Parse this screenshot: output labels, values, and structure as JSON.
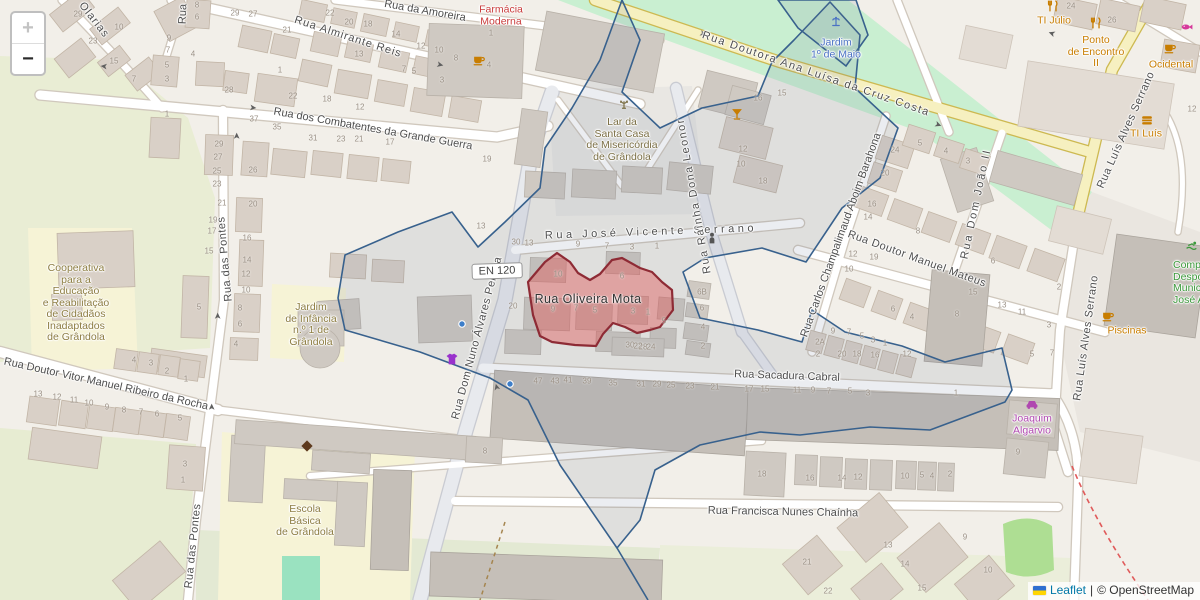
{
  "attribution": {
    "leaflet": "Leaflet",
    "separator": "|",
    "osm": "© OpenStreetMap"
  },
  "controls": {
    "zoom_in": "+",
    "zoom_out": "−"
  },
  "shield": {
    "label": "EN 120"
  },
  "highlight": {
    "label": "Rua Oliveira Mota"
  },
  "colors": {
    "highlight_fill": "#e05a5a",
    "highlight_stroke": "#8e2b35",
    "boundary": "#38618d",
    "park_green": "#c9efd1",
    "school_yellow": "#f6f3d6",
    "road_yellow": "#f6f0c0",
    "poi_orange": "#c87d00",
    "pharmacy_red": "#c93c3c",
    "garden_blue": "#4a71c4",
    "amenity_brown": "#8d7d42",
    "shop_purple": "#b048b0",
    "leisure_green": "#3c9a3c",
    "attribution_link": "#0078A8",
    "housenumber_gray": "#9b9186"
  },
  "street_labels": [
    {
      "t": "Rua da Amoreira",
      "x": 425,
      "y": 11,
      "r": 10,
      "ls": 0
    },
    {
      "t": "Rua Almirante Reis",
      "x": 348,
      "y": 37,
      "r": 18,
      "ls": 1
    },
    {
      "t": "Rua dos Combatentes da Grande Guerra",
      "x": 373,
      "y": 129,
      "r": 10,
      "ls": 0
    },
    {
      "t": "Olarias",
      "x": 94,
      "y": 20,
      "r": 52,
      "ls": 1
    },
    {
      "t": "Rua",
      "x": 183,
      "y": 14,
      "r": -88,
      "ls": 0
    },
    {
      "t": "Rua Doutora Ana Luísa da Cruz Costa",
      "x": 816,
      "y": 74,
      "r": 19,
      "ls": 1.5
    },
    {
      "t": "Rua Luís Alves Serrano",
      "x": 1126,
      "y": 130,
      "r": -66,
      "ls": 0.5
    },
    {
      "t": "Rua Luís Alves Serrano",
      "x": 1086,
      "y": 338,
      "r": -82,
      "ls": 0.5
    },
    {
      "t": "Rua das Pontes",
      "x": 225,
      "y": 259,
      "r": -95,
      "ls": 0.5
    },
    {
      "t": "Rua das Pontes",
      "x": 193,
      "y": 546,
      "r": -84,
      "ls": 0.5
    },
    {
      "t": "Rua Doutor Vitor Manuel Ribeiro da Rocha",
      "x": 106,
      "y": 384,
      "r": 12.5,
      "ls": 0
    },
    {
      "t": "Rua Dom Nuno Álvares Pereira",
      "x": 477,
      "y": 338,
      "r": -75,
      "ls": 0.5
    },
    {
      "t": "Rua José Vicente Serrano",
      "x": 651,
      "y": 232,
      "r": -2,
      "ls": 3.5
    },
    {
      "t": "Rua Rainha Dona Leonor",
      "x": 694,
      "y": 196,
      "r": -100,
      "ls": 1.5
    },
    {
      "t": "Rua Doutor Manuel Mateus",
      "x": 917,
      "y": 259,
      "r": 20,
      "ls": 0.5
    },
    {
      "t": "Rua Carlos Champalimaud Aboim Barahona",
      "x": 841,
      "y": 235,
      "r": -70,
      "ls": 0
    },
    {
      "t": "Rua Dom João II",
      "x": 976,
      "y": 204,
      "r": -78,
      "ls": 2
    },
    {
      "t": "Rua Sacadura Cabral",
      "x": 787,
      "y": 376,
      "r": 2,
      "ls": 0
    },
    {
      "t": "Rua Francisca Nunes Chaínha",
      "x": 783,
      "y": 512,
      "r": 1,
      "ls": 0
    }
  ],
  "poi_labels": [
    {
      "id": "farmacia-moderna",
      "lines": [
        "Farmácia",
        "Moderna"
      ],
      "x": 501,
      "y": 16,
      "color": "#c93c3c"
    },
    {
      "id": "lar-santa-casa",
      "lines": [
        "Lar da",
        "Santa Casa",
        "de Misericórdia",
        "de Grândola"
      ],
      "x": 622,
      "y": 140,
      "color": "#7b6f45"
    },
    {
      "id": "jardim-1-maio",
      "lines": [
        "Jardim",
        "1º de Maio"
      ],
      "x": 836,
      "y": 49,
      "color": "#4a71c4"
    },
    {
      "id": "cooperativa",
      "lines": [
        "Cooperativa",
        "para a",
        "Educação",
        "e Reabilitação",
        "de Cidadãos",
        "Inadaptados",
        "de Grândola"
      ],
      "x": 76,
      "y": 303,
      "color": "#8d7d42"
    },
    {
      "id": "jardim-infancia",
      "lines": [
        "Jardim",
        "de Infância",
        "n.º 1 de",
        "Grândola"
      ],
      "x": 311,
      "y": 325,
      "color": "#8d7d42"
    },
    {
      "id": "escola-basica",
      "lines": [
        "Escola",
        "Básica",
        "de Grândola"
      ],
      "x": 305,
      "y": 521,
      "color": "#8d7d42"
    },
    {
      "id": "ti-julio",
      "lines": [
        "TI Júlio"
      ],
      "x": 1054,
      "y": 21,
      "color": "#c87d00"
    },
    {
      "id": "ponto-de-encontro",
      "lines": [
        "Ponto",
        "de Encontro",
        "II"
      ],
      "x": 1096,
      "y": 52,
      "color": "#c87d00"
    },
    {
      "id": "ocidental",
      "lines": [
        "Ocidental"
      ],
      "x": 1171,
      "y": 65,
      "color": "#c87d00"
    },
    {
      "id": "ti-luis",
      "lines": [
        "TI Luís"
      ],
      "x": 1146,
      "y": 134,
      "color": "#c87d00"
    },
    {
      "id": "piscinas",
      "lines": [
        "Piscinas"
      ],
      "x": 1127,
      "y": 331,
      "color": "#c87d00"
    },
    {
      "id": "joaquim-algarvio",
      "lines": [
        "Joaquim",
        "Algarvio"
      ],
      "x": 1032,
      "y": 425,
      "color": "#b048b0"
    },
    {
      "id": "complexo-desportivo",
      "lines": [
        "Complexo",
        "Desportivo",
        "Municipal",
        "José Afonso"
      ],
      "x": 1173,
      "y": 283,
      "color": "#3c9a3c",
      "align": "left"
    }
  ],
  "icons": [
    {
      "type": "cafe",
      "x": 479,
      "y": 60,
      "color": "#c87d00"
    },
    {
      "type": "cafe",
      "x": 1170,
      "y": 48,
      "color": "#c87d00"
    },
    {
      "type": "cafe",
      "x": 1108,
      "y": 316,
      "color": "#c87d00"
    },
    {
      "type": "cutlery",
      "x": 1053,
      "y": 6,
      "color": "#c87d00"
    },
    {
      "type": "cutlery",
      "x": 1096,
      "y": 23,
      "color": "#c87d00"
    },
    {
      "type": "burger",
      "x": 1147,
      "y": 120,
      "color": "#c87d00"
    },
    {
      "type": "cocktail",
      "x": 737,
      "y": 114,
      "color": "#c87d00"
    },
    {
      "type": "fish",
      "x": 1187,
      "y": 27,
      "color": "#d6399b"
    },
    {
      "type": "car",
      "x": 1032,
      "y": 404,
      "color": "#b048b0"
    },
    {
      "type": "fountain",
      "x": 836,
      "y": 22,
      "color": "#4a71c4"
    },
    {
      "type": "diamond",
      "x": 307,
      "y": 446,
      "color": "#5e3a1e"
    },
    {
      "type": "statue",
      "x": 712,
      "y": 238,
      "color": "#555555"
    },
    {
      "type": "swim",
      "x": 1192,
      "y": 246,
      "color": "#3c9a3c"
    },
    {
      "type": "shirt",
      "x": 452,
      "y": 359,
      "color": "#9932cc"
    },
    {
      "type": "emblem",
      "x": 624,
      "y": 105,
      "color": "#7b6f45"
    },
    {
      "type": "dot",
      "x": 462,
      "y": 324,
      "color": "#3d7ec9"
    },
    {
      "type": "dot",
      "x": 510,
      "y": 384,
      "color": "#3d7ec9"
    }
  ],
  "oneway_arrows": [
    {
      "ch": "➤",
      "x": 253,
      "y": 108,
      "r": 6
    },
    {
      "ch": "➤",
      "x": 440,
      "y": 65,
      "r": 13
    },
    {
      "ch": "➤",
      "x": 703,
      "y": 34,
      "r": 19
    },
    {
      "ch": "➤",
      "x": 938,
      "y": 125,
      "r": 21
    },
    {
      "ch": "➤",
      "x": 1052,
      "y": 33,
      "r": 200
    },
    {
      "ch": "➤",
      "x": 237,
      "y": 136,
      "r": -90
    },
    {
      "ch": "➤",
      "x": 218,
      "y": 316,
      "r": -90
    },
    {
      "ch": "➤",
      "x": 212,
      "y": 407,
      "r": -90
    },
    {
      "ch": "➤",
      "x": 497,
      "y": 387,
      "r": -105
    },
    {
      "ch": "➤",
      "x": 104,
      "y": 66,
      "r": 186
    }
  ],
  "house_numbers": [
    [
      "29",
      78,
      14
    ],
    [
      "23",
      93,
      41
    ],
    [
      "15",
      114,
      61
    ],
    [
      "7",
      134,
      79
    ],
    [
      "10",
      119,
      27
    ],
    [
      "8",
      197,
      5
    ],
    [
      "6",
      197,
      17
    ],
    [
      "9",
      169,
      38
    ],
    [
      "7",
      168,
      50
    ],
    [
      "5",
      167,
      65
    ],
    [
      "3",
      167,
      79
    ],
    [
      "4",
      193,
      54
    ],
    [
      "28",
      229,
      90
    ],
    [
      "29",
      235,
      13
    ],
    [
      "27",
      253,
      14
    ],
    [
      "21",
      287,
      30
    ],
    [
      "22",
      330,
      13
    ],
    [
      "20",
      349,
      22
    ],
    [
      "18",
      368,
      24
    ],
    [
      "14",
      396,
      34
    ],
    [
      "13",
      359,
      54
    ],
    [
      "12",
      421,
      46
    ],
    [
      "10",
      439,
      50
    ],
    [
      "8",
      456,
      58
    ],
    [
      "7",
      404,
      69
    ],
    [
      "5",
      414,
      71
    ],
    [
      "4",
      489,
      65
    ],
    [
      "1",
      491,
      33
    ],
    [
      "3",
      442,
      80
    ],
    [
      "1",
      280,
      70
    ],
    [
      "22",
      293,
      96
    ],
    [
      "18",
      327,
      99
    ],
    [
      "12",
      360,
      107
    ],
    [
      "37",
      254,
      119
    ],
    [
      "35",
      277,
      127
    ],
    [
      "31",
      313,
      138
    ],
    [
      "23",
      341,
      139
    ],
    [
      "21",
      359,
      139
    ],
    [
      "17",
      390,
      142
    ],
    [
      "1",
      167,
      114
    ],
    [
      "29",
      219,
      144
    ],
    [
      "27",
      218,
      157
    ],
    [
      "25",
      217,
      171
    ],
    [
      "23",
      217,
      184
    ],
    [
      "26",
      253,
      170
    ],
    [
      "19",
      487,
      159
    ],
    [
      "24",
      1071,
      6
    ],
    [
      "26",
      1112,
      20
    ],
    [
      "16",
      758,
      98
    ],
    [
      "15",
      782,
      93
    ],
    [
      "12",
      743,
      149
    ],
    [
      "10",
      741,
      164
    ],
    [
      "18",
      763,
      181
    ],
    [
      "24",
      895,
      150
    ],
    [
      "20",
      885,
      173
    ],
    [
      "5",
      920,
      143
    ],
    [
      "4",
      946,
      151
    ],
    [
      "3",
      968,
      161
    ],
    [
      "12",
      1192,
      109
    ],
    [
      "30",
      516,
      242
    ],
    [
      "13",
      529,
      243
    ],
    [
      "13",
      481,
      226
    ],
    [
      "9",
      578,
      244
    ],
    [
      "7",
      607,
      246
    ],
    [
      "3",
      632,
      247
    ],
    [
      "1",
      657,
      246
    ],
    [
      "10",
      558,
      274
    ],
    [
      "6",
      622,
      276
    ],
    [
      "20",
      513,
      306
    ],
    [
      "9",
      553,
      309
    ],
    [
      "7",
      576,
      308
    ],
    [
      "5",
      595,
      310
    ],
    [
      "3",
      633,
      311
    ],
    [
      "1",
      648,
      312
    ],
    [
      "30",
      630,
      345
    ],
    [
      "28",
      643,
      347
    ],
    [
      "6B",
      702,
      292
    ],
    [
      "6",
      702,
      308
    ],
    [
      "5",
      664,
      321
    ],
    [
      "4",
      703,
      327
    ],
    [
      "2",
      703,
      346
    ],
    [
      "22",
      638,
      346
    ],
    [
      "24",
      651,
      347
    ],
    [
      "16",
      872,
      204
    ],
    [
      "14",
      868,
      217
    ],
    [
      "8",
      918,
      231
    ],
    [
      "12",
      853,
      254
    ],
    [
      "19",
      874,
      257
    ],
    [
      "10",
      849,
      269
    ],
    [
      "6",
      893,
      309
    ],
    [
      "4",
      912,
      317
    ],
    [
      "6",
      993,
      261
    ],
    [
      "2",
      1059,
      287
    ],
    [
      "15",
      973,
      292
    ],
    [
      "13",
      1002,
      305
    ],
    [
      "11",
      1022,
      312
    ],
    [
      "3",
      1049,
      325
    ],
    [
      "8",
      957,
      314
    ],
    [
      "5",
      1032,
      354
    ],
    [
      "7",
      1052,
      353
    ],
    [
      "2A",
      820,
      342
    ],
    [
      "2",
      818,
      354
    ],
    [
      "20",
      842,
      354
    ],
    [
      "18",
      857,
      354
    ],
    [
      "16",
      875,
      355
    ],
    [
      "12",
      907,
      354
    ],
    [
      "9",
      833,
      331
    ],
    [
      "7",
      849,
      332
    ],
    [
      "5",
      862,
      336
    ],
    [
      "3",
      873,
      340
    ],
    [
      "1",
      885,
      343
    ],
    [
      "47",
      538,
      381
    ],
    [
      "43",
      555,
      381
    ],
    [
      "41",
      568,
      380
    ],
    [
      "39",
      587,
      381
    ],
    [
      "35",
      613,
      383
    ],
    [
      "31",
      641,
      384
    ],
    [
      "29",
      657,
      384
    ],
    [
      "25",
      671,
      385
    ],
    [
      "23",
      690,
      386
    ],
    [
      "21",
      715,
      387
    ],
    [
      "17",
      749,
      389
    ],
    [
      "15",
      765,
      389
    ],
    [
      "11",
      797,
      390
    ],
    [
      "9",
      813,
      390
    ],
    [
      "7",
      829,
      391
    ],
    [
      "5",
      850,
      391
    ],
    [
      "3",
      868,
      393
    ],
    [
      "1",
      956,
      393
    ],
    [
      "13",
      38,
      394
    ],
    [
      "12",
      57,
      397
    ],
    [
      "11",
      74,
      400
    ],
    [
      "10",
      89,
      403
    ],
    [
      "9",
      107,
      407
    ],
    [
      "8",
      124,
      410
    ],
    [
      "7",
      141,
      412
    ],
    [
      "6",
      157,
      414
    ],
    [
      "5",
      180,
      418
    ],
    [
      "4",
      134,
      360
    ],
    [
      "3",
      151,
      363
    ],
    [
      "2",
      167,
      371
    ],
    [
      "1",
      186,
      379
    ],
    [
      "3",
      185,
      464
    ],
    [
      "1",
      183,
      480
    ],
    [
      "4",
      236,
      344
    ],
    [
      "21",
      222,
      203
    ],
    [
      "20",
      253,
      204
    ],
    [
      "19",
      213,
      220
    ],
    [
      "17",
      212,
      231
    ],
    [
      "15",
      209,
      251
    ],
    [
      "16",
      247,
      238
    ],
    [
      "14",
      247,
      260
    ],
    [
      "12",
      246,
      274
    ],
    [
      "10",
      246,
      290
    ],
    [
      "8",
      240,
      308
    ],
    [
      "6",
      240,
      324
    ],
    [
      "5",
      199,
      307
    ],
    [
      "8",
      485,
      451
    ],
    [
      "18",
      762,
      474
    ],
    [
      "16",
      810,
      478
    ],
    [
      "14",
      842,
      478
    ],
    [
      "12",
      858,
      477
    ],
    [
      "10",
      905,
      476
    ],
    [
      "5",
      922,
      475
    ],
    [
      "4",
      932,
      476
    ],
    [
      "2",
      950,
      474
    ],
    [
      "9",
      1018,
      452
    ],
    [
      "13",
      888,
      545
    ],
    [
      "14",
      905,
      564
    ],
    [
      "15",
      922,
      588
    ],
    [
      "21",
      807,
      562
    ],
    [
      "22",
      828,
      591
    ],
    [
      "9",
      965,
      537
    ],
    [
      "10",
      988,
      570
    ]
  ]
}
